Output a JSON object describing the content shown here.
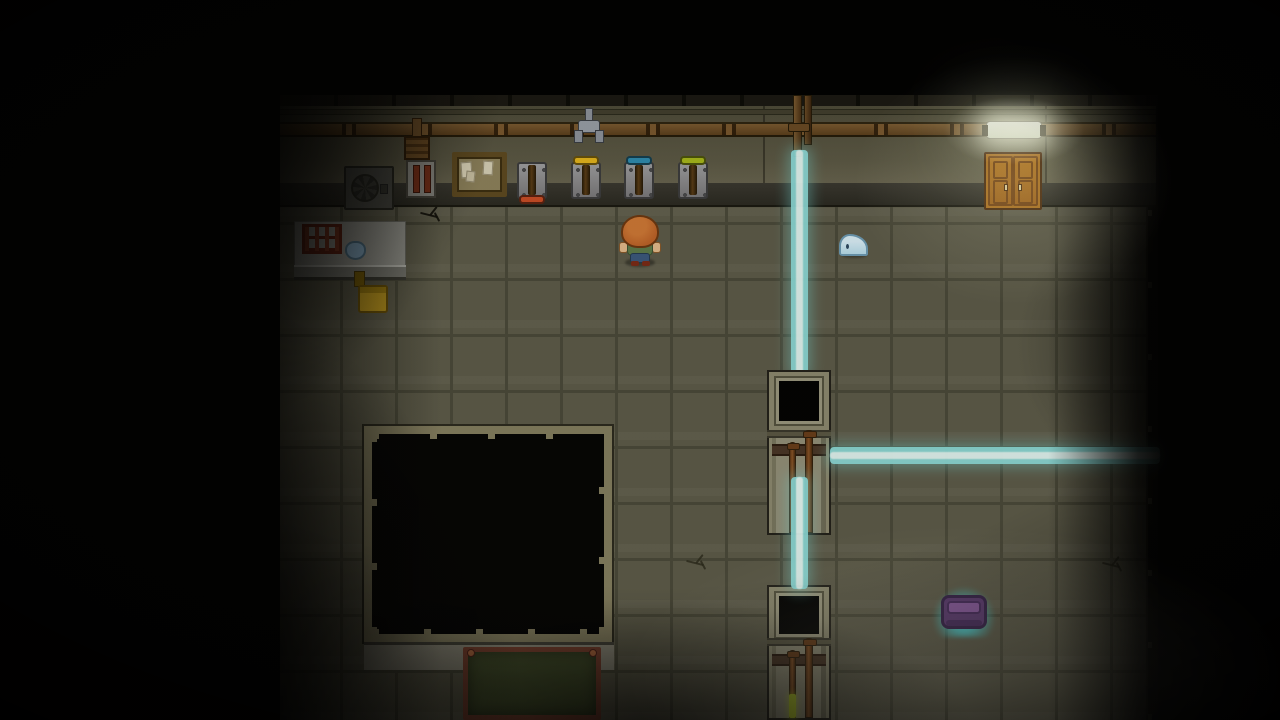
{
  "scene": {
    "name": "top-down stealth game room",
    "visible_text": "none"
  },
  "colors": {
    "laser": "#8fe0dd",
    "laser-core": "#eafffb",
    "floor": "#5e5c4a",
    "grout": "#4b4a3a",
    "wall": "#55523f",
    "pipe": "#6d4e28",
    "wood": "#b5761f",
    "hair": "#c06428",
    "skin": "#e6bd8d",
    "shirt": "#5f7c4a",
    "pants": "#3b5a7e",
    "slime": "#b9e0ef",
    "lever-red": "#cc4d26",
    "lever-yellow": "#e7b71d",
    "lever-blue": "#2e8db1",
    "lever-green": "#aaba1b",
    "chair": "#c49d1f",
    "chalkboard": "#45502c",
    "chalk-frame": "#7c4230",
    "item-purple": "#5c3a72",
    "item-glow": "#46e6eb",
    "goo-pipe": "#b7cc28",
    "lamp": "#f6faee"
  },
  "entities": {
    "player": {
      "label": "player character",
      "hair_color": "orange",
      "shirt_color": "green",
      "facing": "south"
    },
    "slime": {
      "label": "small blue slime creature"
    },
    "levers": [
      {
        "color": "red",
        "position": "down"
      },
      {
        "color": "yellow",
        "position": "up"
      },
      {
        "color": "blue",
        "position": "up"
      },
      {
        "color": "green",
        "position": "up"
      }
    ],
    "laser_beams": [
      {
        "orientation": "vertical",
        "segments": 2,
        "state": "on"
      },
      {
        "orientation": "horizontal",
        "segments": 1,
        "state": "on"
      }
    ],
    "ceiling_lamp": {
      "state": "on"
    },
    "wooden_cabinet": {
      "doors": 2
    },
    "pipe_valve": {
      "label": "valve on wall pipe"
    },
    "bulletin_board": {
      "papers": 3
    },
    "lab_table": {
      "items": [
        "red bottle rack",
        "blue flask"
      ]
    },
    "chair": {
      "color": "yellow"
    },
    "ac_unit": {
      "label": "wall machine with fan"
    },
    "dark_room": {
      "label": "unlit walled room"
    },
    "chalkboard": {
      "label": "green chalkboard"
    },
    "glow_item": {
      "label": "purple couch highlighted with cyan glow"
    },
    "pillars": [
      {
        "label": "pipe column with dark window",
        "pipes": 2
      },
      {
        "label": "pipe column with dark window and glowing green pipe",
        "pipes": 2
      }
    ],
    "floor_cracks": 3
  }
}
